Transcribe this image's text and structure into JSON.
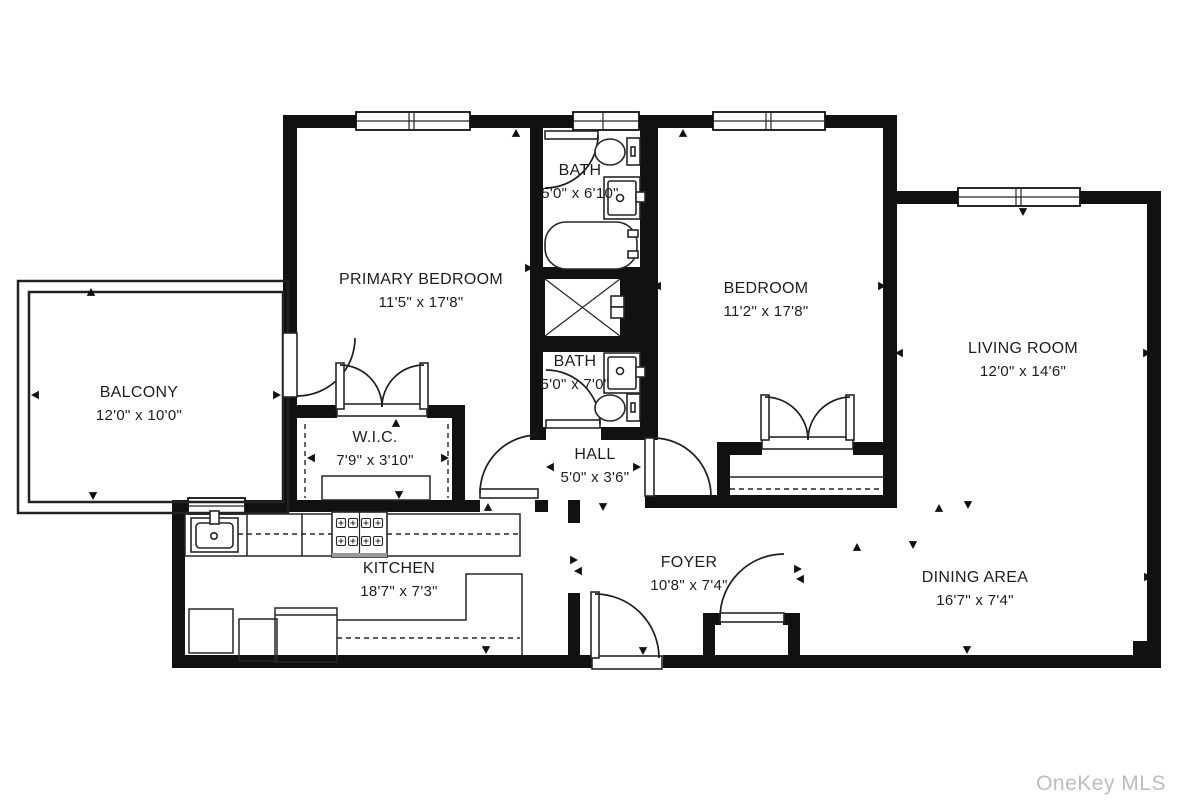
{
  "watermark": "OneKey MLS",
  "colors": {
    "wall": "#111111",
    "fixture": "#262626",
    "watermark": "#bdbdbd"
  },
  "rooms": [
    {
      "id": "primary-bedroom",
      "name": "PRIMARY BEDROOM",
      "dims": "11'5\" x 17'8\""
    },
    {
      "id": "bath-1",
      "name": "BATH",
      "dims": "5'0\" x 6'10\""
    },
    {
      "id": "bedroom",
      "name": "BEDROOM",
      "dims": "11'2\" x 17'8\""
    },
    {
      "id": "living-room",
      "name": "LIVING ROOM",
      "dims": "12'0\" x 14'6\""
    },
    {
      "id": "balcony",
      "name": "BALCONY",
      "dims": "12'0\" x 10'0\""
    },
    {
      "id": "wic",
      "name": "W.I.C.",
      "dims": "7'9\" x 3'10\""
    },
    {
      "id": "bath-2",
      "name": "BATH",
      "dims": "5'0\" x 7'0\""
    },
    {
      "id": "hall",
      "name": "HALL",
      "dims": "5'0\" x 3'6\""
    },
    {
      "id": "kitchen",
      "name": "KITCHEN",
      "dims": "18'7\" x 7'3\""
    },
    {
      "id": "foyer",
      "name": "FOYER",
      "dims": "10'8\" x 7'4\""
    },
    {
      "id": "dining-area",
      "name": "DINING AREA",
      "dims": "16'7\" x 7'4\""
    }
  ]
}
